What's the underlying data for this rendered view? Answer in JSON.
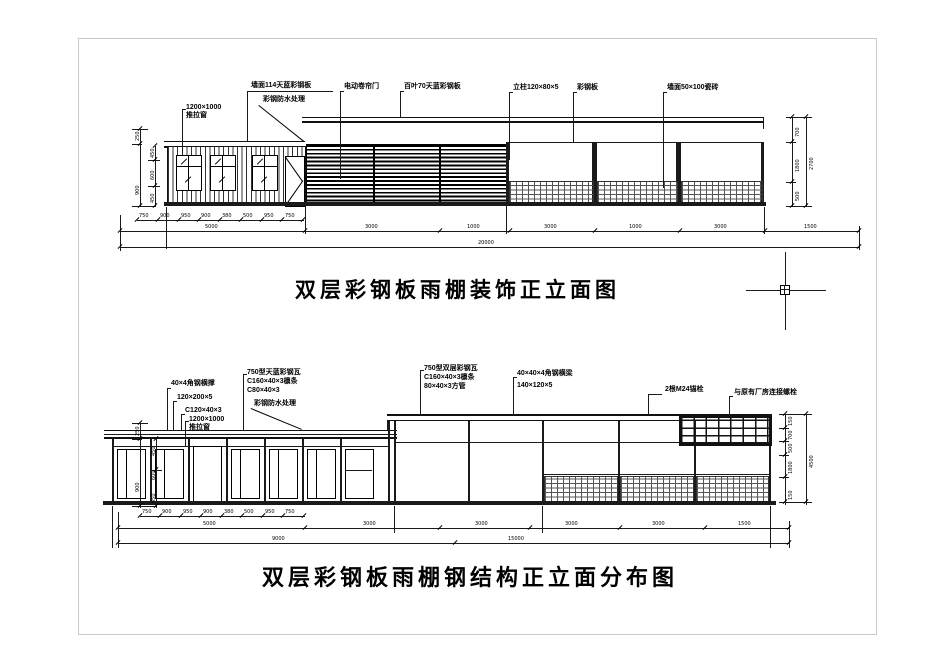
{
  "top_view": {
    "title": "双层彩钢板雨棚装饰正立面图",
    "labels": {
      "wall_panel": "墙面114天蓝彩钢板",
      "waterproof": "彩钢防水处理",
      "window_size": "1200×1000",
      "window_type": "推拉窗",
      "rolling_door": "电动卷帘门",
      "louver": "百叶70天蓝彩钢板",
      "column": "立柱120×80×5",
      "steel_plate": "彩钢板",
      "wall_tile": "墙面50×100瓷砖"
    },
    "dims": {
      "detail": [
        "750",
        "900",
        "950",
        "900",
        "380",
        "500",
        "950",
        "750"
      ],
      "main": [
        "5000",
        "3000",
        "1000",
        "3000",
        "1000",
        "3000",
        "1500"
      ],
      "overall": "20000",
      "left": [
        "250",
        "900",
        "450",
        "600",
        "450"
      ],
      "right": [
        "700",
        "1800",
        "500",
        "2700"
      ]
    }
  },
  "bottom_view": {
    "title": "双层彩钢板雨棚钢结构正立面分布图",
    "labels": {
      "angle_brace": "40×4角钢横撑",
      "beam_120": "120×200×5",
      "purlin_c120": "C120×40×3",
      "window_size": "1200×1000",
      "window_type": "推拉窗",
      "roof_sheet_a": "750型天蓝彩钢瓦",
      "purlin_a": "C160×40×3檩条",
      "tube_a": "C80×40×3",
      "waterproof": "彩钢防水处理",
      "roof_sheet_b": "750型双层彩钢瓦",
      "purlin_b": "C160×40×3檩条",
      "tube_b": "80×40×3方管",
      "angle_beam": "40×40×4角钢横梁",
      "beam_140": "140×120×5",
      "anchor": "2根M24锚栓",
      "connect": "与原有厂房连接螺栓"
    },
    "dims": {
      "detail": [
        "750",
        "900",
        "950",
        "900",
        "380",
        "500",
        "950",
        "750"
      ],
      "main": [
        "5000",
        "3000",
        "3000",
        "3000",
        "3000",
        "1500"
      ],
      "overall": [
        "9000",
        "15000"
      ],
      "left": [
        "250",
        "900",
        "450",
        "600",
        "450"
      ],
      "right": [
        "150",
        "700",
        "500",
        "1800",
        "150",
        "4500"
      ]
    }
  }
}
